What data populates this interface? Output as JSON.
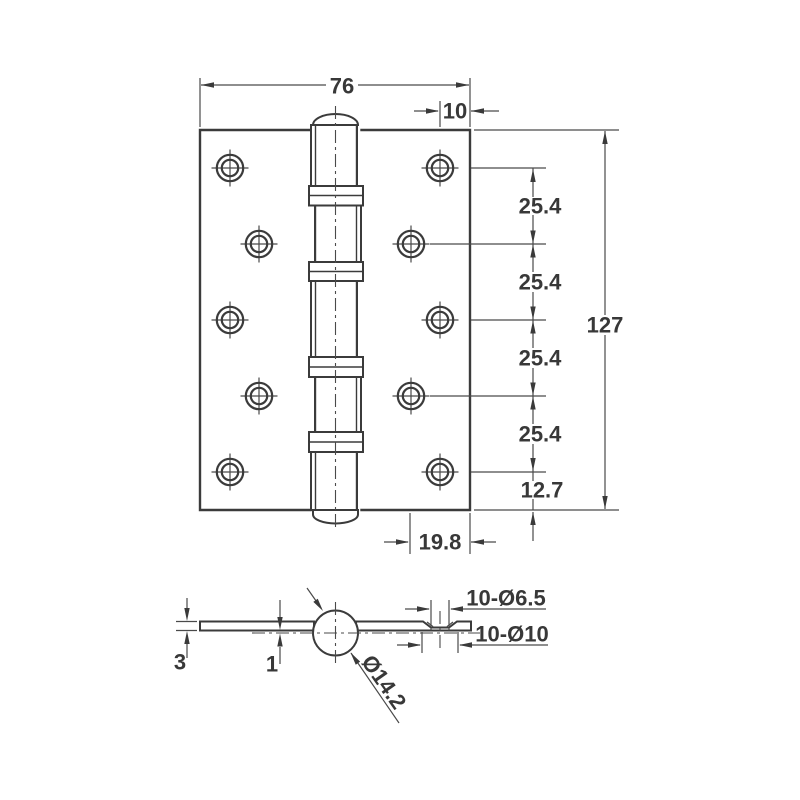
{
  "drawing": {
    "type": "technical-drawing",
    "subject": "door-hinge",
    "front_view": {
      "width_mm": "76",
      "hole_edge_offset_mm": "10",
      "hole_pitch_mm": [
        "25.4",
        "25.4",
        "25.4",
        "25.4"
      ],
      "height_mm": "127",
      "bottom_hole_offset_mm": "12.7",
      "inner_hole_offset_mm": "19.8"
    },
    "section_view": {
      "leaf_thickness_mm": "3",
      "leaf_to_center_offset_mm": "1",
      "knuckle_diameter": "Ø14.2",
      "screw_holes": "10-Ø6.5",
      "countersinks": "10-Ø10"
    },
    "colors": {
      "line": "#3b3b3b",
      "dimension": "#4a4a4a",
      "background": "#ffffff"
    }
  }
}
